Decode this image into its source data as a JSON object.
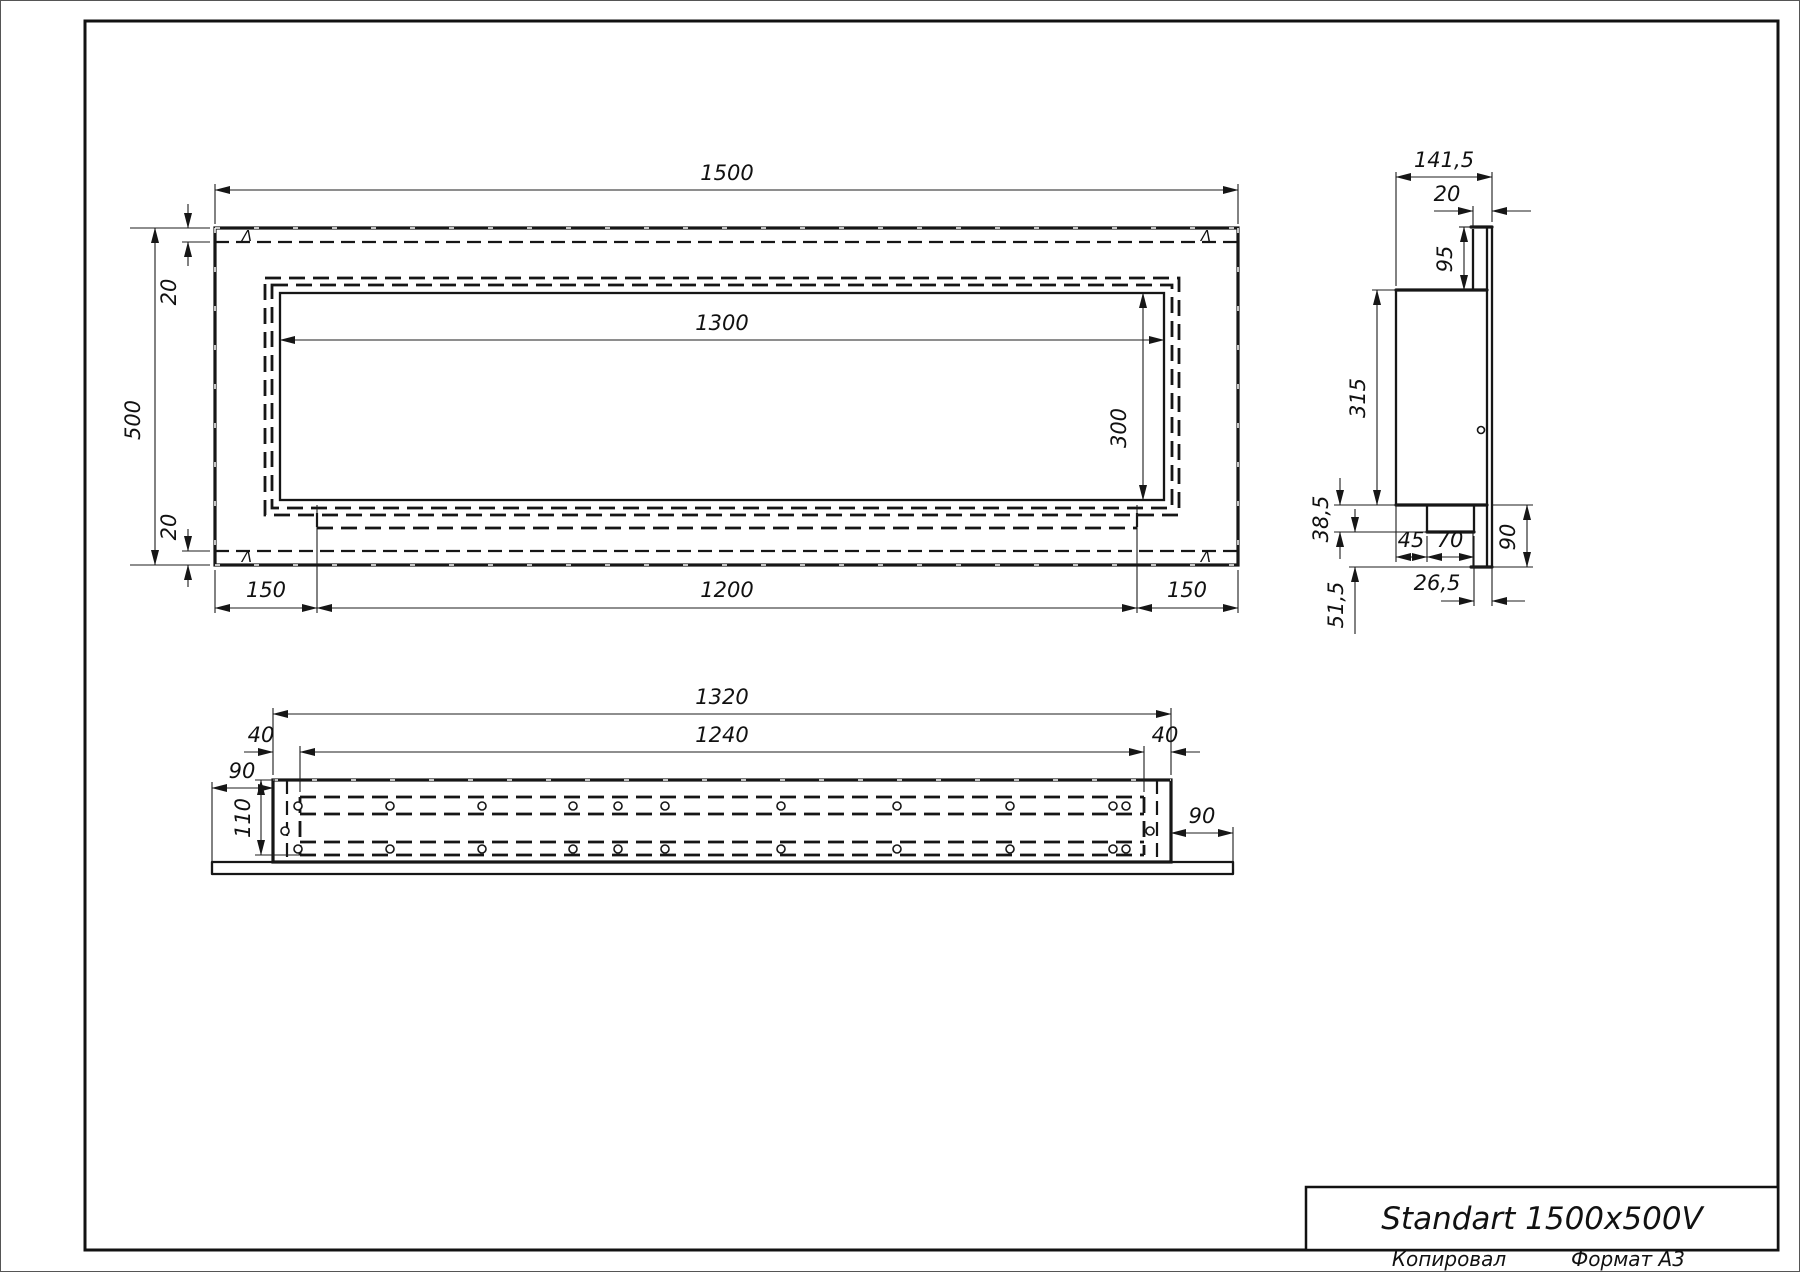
{
  "title_block": {
    "title": "Standart 1500x500V",
    "copied_label": "Копировал",
    "format_label": "Формат A3"
  },
  "annotations": {
    "corner_mark": "Λ"
  },
  "front_view": {
    "dims": {
      "overall_width": "1500",
      "overall_height": "500",
      "top_fold": "20",
      "bottom_fold": "20",
      "opening_width": "1300",
      "opening_height": "300",
      "left_margin": "150",
      "bracket_width": "1200",
      "right_margin": "150"
    }
  },
  "side_view": {
    "dims": {
      "depth": "141,5",
      "flange_fold": "20",
      "top_offset": "95",
      "box_height": "315",
      "step_down": "38,5",
      "bracket_offset": "45",
      "bracket_width": "70",
      "bottom_offset": "90",
      "bracket_to_flange": "26,5",
      "lower_extension": "51,5"
    }
  },
  "bottom_view": {
    "dims": {
      "box_length": "1320",
      "inner_length": "1240",
      "fold_left": "40",
      "fold_right": "40",
      "lip_left": "90",
      "lip_right": "90",
      "depth": "110"
    },
    "holes": {
      "r": 4,
      "top_row_y": 806,
      "bottom_row_y": 849,
      "xs": [
        298,
        390,
        482,
        573,
        618,
        665,
        781,
        897,
        1010,
        1113,
        1126
      ],
      "side": [
        {
          "x": 285,
          "y": 831
        },
        {
          "x": 1150,
          "y": 831
        }
      ]
    }
  }
}
